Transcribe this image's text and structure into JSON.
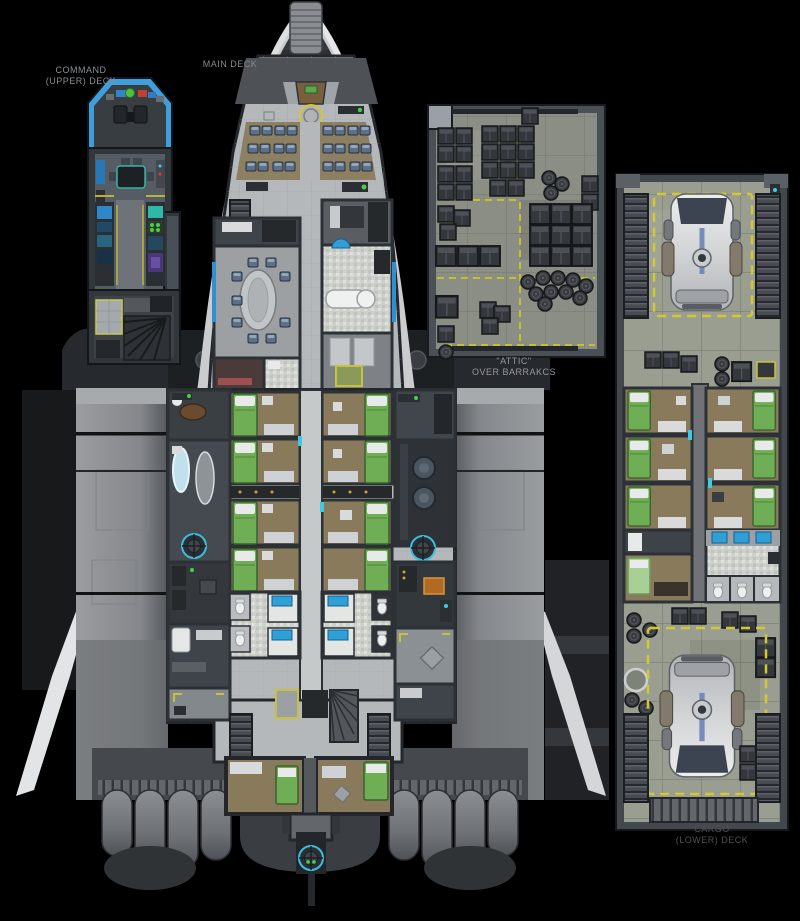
{
  "labels": {
    "command_deck": {
      "line1": "COMMAND",
      "line2": "(UPPER) DECK"
    },
    "main_deck": {
      "line1": "MAIN DECK"
    },
    "attic": {
      "line1": "\"ATTIC\"",
      "line2": "OVER BARRAKCS"
    },
    "cargo_deck": {
      "line1": "CARGO",
      "line2": "(LOWER) DECK"
    }
  },
  "palette": {
    "background": "#000000",
    "hull_light": "#caccce",
    "hull_dark": "#35393d",
    "deck_floor": "#b4b8ba",
    "cabin_floor": "#8a7a5c",
    "bed_green": "#6fae54",
    "stone_floor": "#999e90",
    "hazard_yellow": "#d4c832",
    "airlock_cyan": "#3bbede",
    "canopy_blue": "#3f9fdc",
    "label_gray": "#8a8f93",
    "label_dim": "#4e5154"
  }
}
